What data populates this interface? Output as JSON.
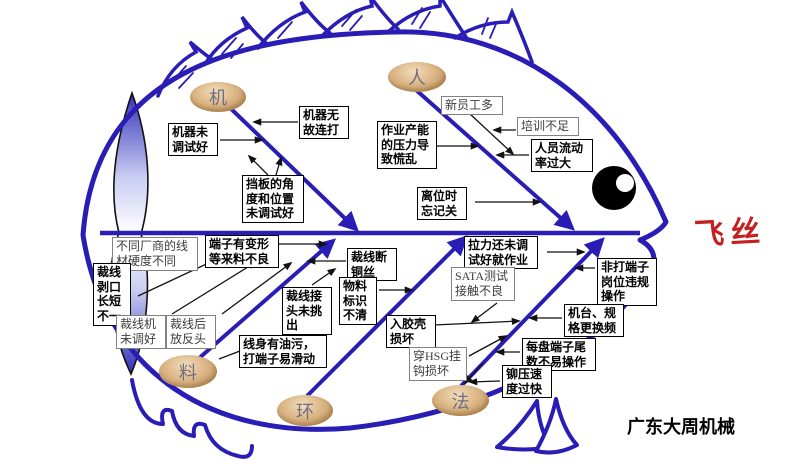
{
  "effect": {
    "label": "飞丝"
  },
  "watermark": "广东大周机械",
  "colors": {
    "bone": "#2a1db5",
    "effect_text": "#c32020",
    "oval_light": "#f2ddba",
    "oval_dark": "#bd9055"
  },
  "categories": [
    {
      "id": "machine",
      "label": "机",
      "causes": [
        {
          "text": "机器未调试好"
        },
        {
          "text": "机器无故连打"
        },
        {
          "text": "挡板的角度和位置未调试好"
        }
      ]
    },
    {
      "id": "man",
      "label": "人",
      "causes": [
        {
          "text": "新员工多"
        },
        {
          "text": "培训不足"
        },
        {
          "text": "人员流动率过大"
        },
        {
          "text": "作业产能的压力导致慌乱"
        },
        {
          "text": "离位时忘记关"
        }
      ]
    },
    {
      "id": "material",
      "label": "料",
      "causes": [
        {
          "text": "不同厂商的线材硬度不同"
        },
        {
          "text": "端子有变形等来料不良"
        },
        {
          "text": "裁线剥口长短不一"
        },
        {
          "text": "裁线机未调好"
        },
        {
          "text": "裁线后放反头"
        },
        {
          "text": "裁线接头未挑出"
        },
        {
          "text": "线身有油污，打端子易滑动"
        },
        {
          "text": "裁线断铜丝"
        }
      ]
    },
    {
      "id": "environment",
      "label": "环",
      "causes": [
        {
          "text": "物料标识不清"
        },
        {
          "text": "入胶壳损坏"
        },
        {
          "text": "穿HSG挂钩损坏"
        }
      ]
    },
    {
      "id": "method",
      "label": "法",
      "causes": [
        {
          "text": "拉力还未调试好就作业"
        },
        {
          "text": "SATA测试接触不良"
        },
        {
          "text": "非打端子岗位违规操作"
        },
        {
          "text": "机台、规格更换频"
        },
        {
          "text": "每盘端子尾数不易操作"
        },
        {
          "text": "铆压速度过快"
        }
      ]
    }
  ]
}
